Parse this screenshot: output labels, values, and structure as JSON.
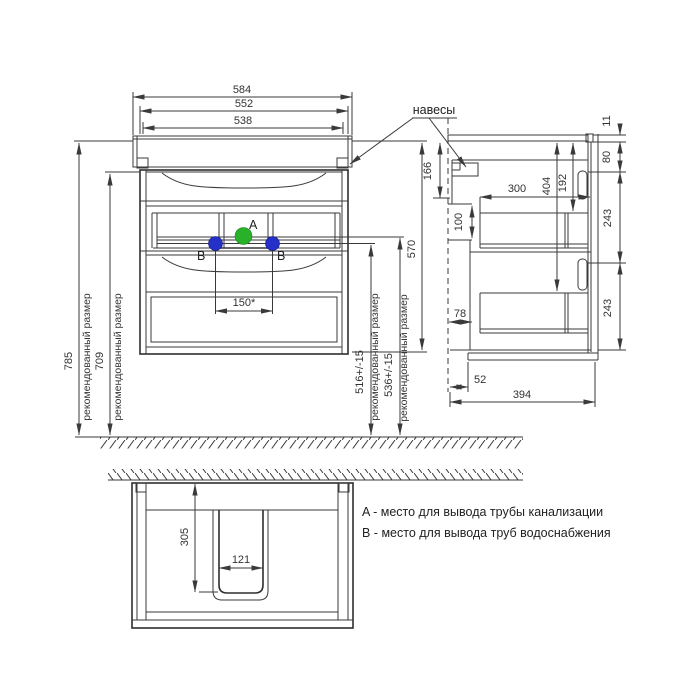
{
  "drawing": {
    "legend": {
      "line_a": "A - место для вывода трубы канализации",
      "line_b": "B - место для вывода труб водоснабжения"
    },
    "labels": {
      "hangers": "навесы",
      "recommended": "рекомендованный размер",
      "point_a": "A",
      "point_b": "B"
    },
    "front": {
      "width_total": "584",
      "width_body": "552",
      "width_inner": "538",
      "height_floor_top": "785",
      "height_floor_body": "709",
      "height_cabinet": "570",
      "water_spacing": "150*",
      "height_water": "516+/-15",
      "height_drain": "536+/-15"
    },
    "side": {
      "hanger_offset": "166",
      "back_gap": "100",
      "drawer_depth": "300",
      "drain_depth": "404",
      "top_offset": "192",
      "top_thickness": "11",
      "apron_height": "80",
      "drawer1_height": "243",
      "drawer2_height": "243",
      "bottom_back_offset": "78",
      "bottom_gap": "52",
      "depth_total": "394"
    },
    "bottom": {
      "cutout_depth": "305",
      "cutout_width": "121"
    },
    "colors": {
      "line": "#3a3a3a",
      "drain_point": "#29b229",
      "water_point": "#2430c8"
    }
  }
}
